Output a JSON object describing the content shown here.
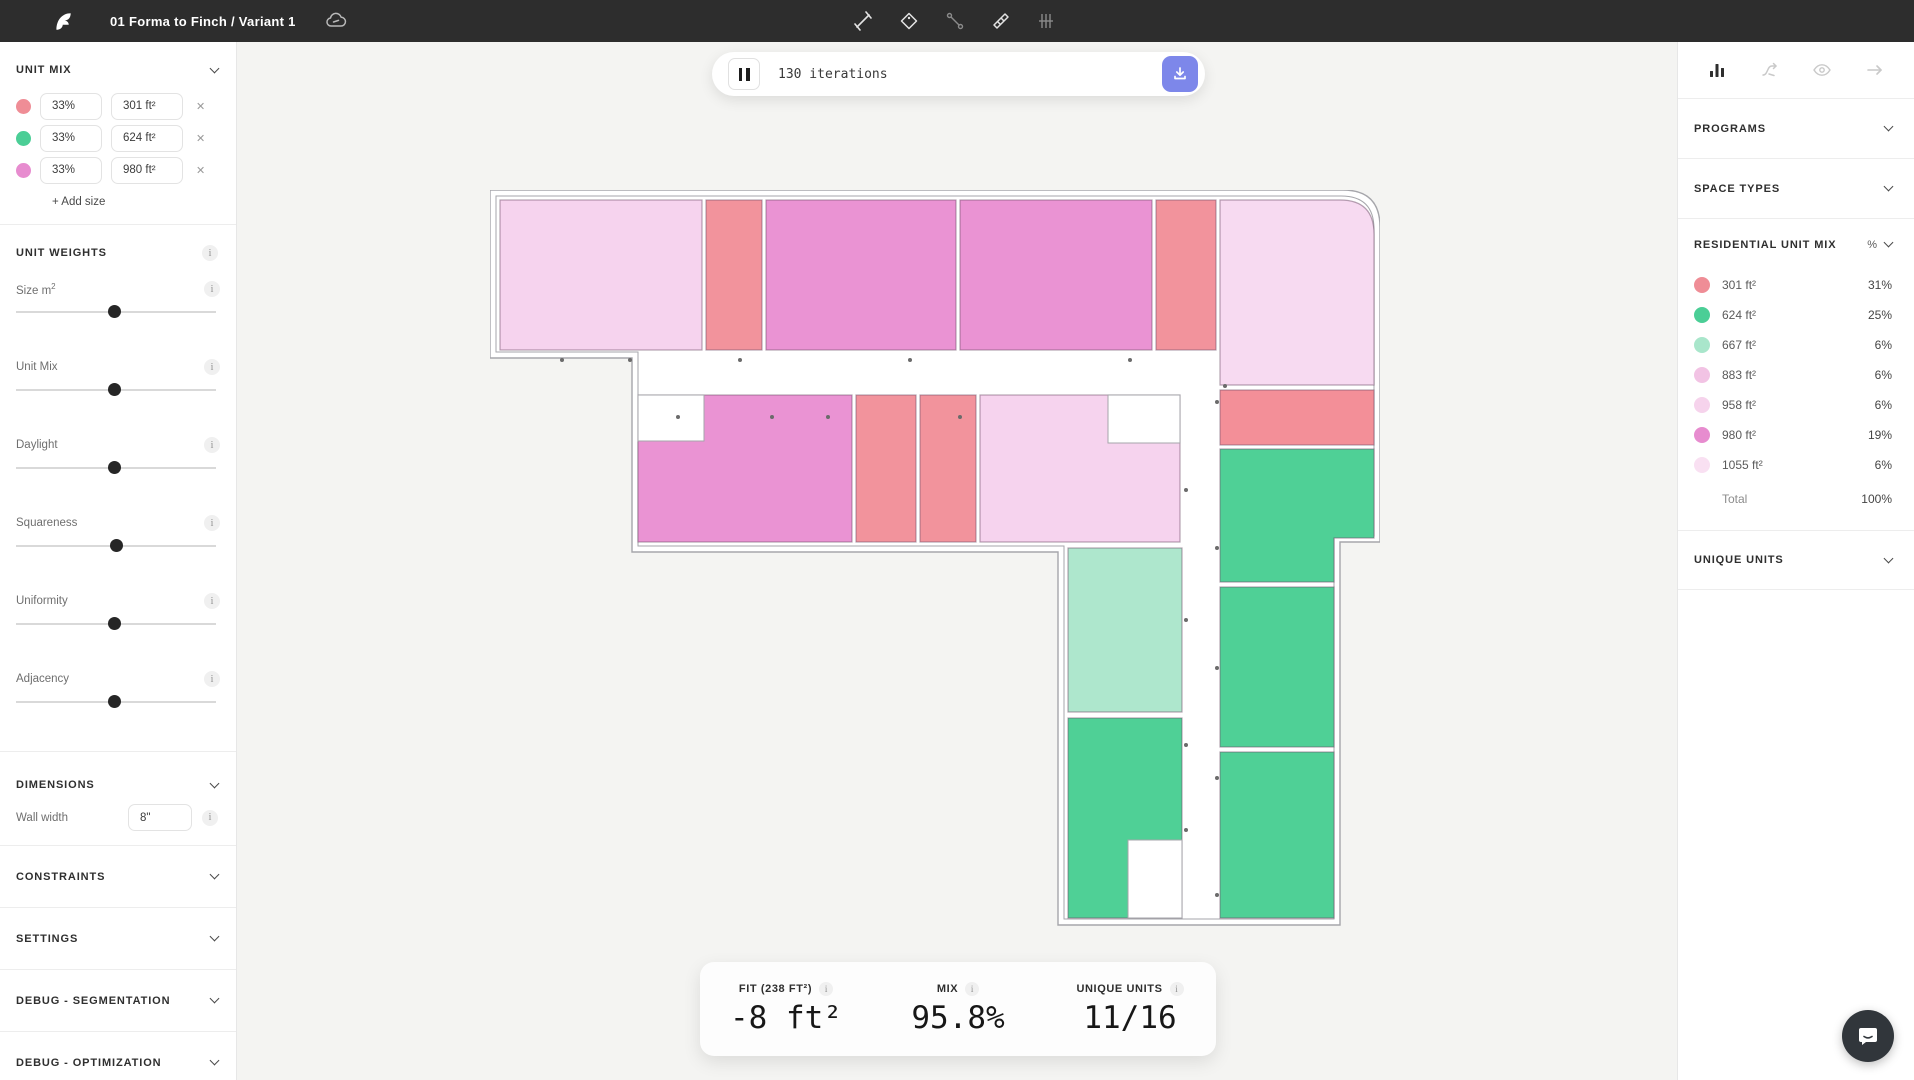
{
  "header": {
    "title": "01 Forma to Finch / Variant 1"
  },
  "iterations": {
    "label": "130 iterations"
  },
  "left_panel": {
    "unit_mix": {
      "title": "UNIT MIX",
      "rows": [
        {
          "pct": "33%",
          "size": "301 ft²",
          "color": "#ef8d96"
        },
        {
          "pct": "33%",
          "size": "624 ft²",
          "color": "#4bce96"
        },
        {
          "pct": "33%",
          "size": "980 ft²",
          "color": "#e78ccf"
        }
      ],
      "add_label": "+ Add size"
    },
    "unit_weights": {
      "title": "UNIT WEIGHTS",
      "sliders": [
        {
          "label": "Size m²",
          "value": 49
        },
        {
          "label": "Unit Mix",
          "value": 49
        },
        {
          "label": "Daylight",
          "value": 49
        },
        {
          "label": "Squareness",
          "value": 50
        },
        {
          "label": "Uniformity",
          "value": 49
        },
        {
          "label": "Adjacency",
          "value": 49
        }
      ]
    },
    "dimensions": {
      "title": "DIMENSIONS",
      "wall_width_label": "Wall width",
      "wall_width_value": "8\""
    },
    "sections": [
      "CONSTRAINTS",
      "SETTINGS",
      "DEBUG - SEGMENTATION",
      "DEBUG - OPTIMIZATION"
    ]
  },
  "right_panel": {
    "programs_title": "PROGRAMS",
    "space_types_title": "SPACE TYPES",
    "residential_unit_mix": {
      "title": "RESIDENTIAL UNIT MIX",
      "unit_header": "%",
      "rows": [
        {
          "size": "301 ft²",
          "pct": "31%",
          "color": "#ef8d96"
        },
        {
          "size": "624 ft²",
          "pct": "25%",
          "color": "#4bce96"
        },
        {
          "size": "667 ft²",
          "pct": "6%",
          "color": "#a9e6cb"
        },
        {
          "size": "883 ft²",
          "pct": "6%",
          "color": "#f2c3e4"
        },
        {
          "size": "958 ft²",
          "pct": "6%",
          "color": "#f6d3ec"
        },
        {
          "size": "980 ft²",
          "pct": "19%",
          "color": "#e78ccf"
        },
        {
          "size": "1055 ft²",
          "pct": "6%",
          "color": "#f9e0f2"
        }
      ],
      "total_label": "Total",
      "total_value": "100%"
    },
    "unique_units_title": "UNIQUE UNITS"
  },
  "stats": {
    "fit_label": "FIT (238 FT²)",
    "fit_value": "-8 ft²",
    "mix_label": "MIX",
    "mix_value": "95.8%",
    "unique_label": "UNIQUE UNITS",
    "unique_value": "11/16"
  },
  "floorplan": {
    "wall_color": "#a6a6ab",
    "unit_stroke": "rgba(110,78,104,0.5)",
    "outer": "M0,0 L853,0 Q890,0 890,37 L890,352 L850,352 L850,735 L568,735 L568,362 L142,362 L142,168 L0,168 Z",
    "inner": "M6,6 L851,6 Q884,6 884,39 L884,346 L844,346 L844,729 L574,729 L574,356 L148,356 L148,162 L6,162 Z",
    "units": [
      {
        "type": "lightpink",
        "color": "#f6d3ee",
        "x": 10,
        "y": 10,
        "w": 202,
        "h": 150
      },
      {
        "type": "salmon",
        "color": "#f2939c",
        "x": 216,
        "y": 10,
        "w": 56,
        "h": 150
      },
      {
        "type": "orchid",
        "color": "#ea93d3",
        "x": 276,
        "y": 10,
        "w": 190,
        "h": 150
      },
      {
        "type": "orchid",
        "color": "#ea93d3",
        "x": 470,
        "y": 10,
        "w": 192,
        "h": 150
      },
      {
        "type": "salmon",
        "color": "#f2939c",
        "x": 666,
        "y": 10,
        "w": 60,
        "h": 150
      },
      {
        "type": "lightpink",
        "color": "#f7daf1",
        "d": "M730,10 L850,10 Q884,10 884,44 L884,195 L730,195 Z"
      },
      {
        "type": "orchid",
        "color": "#ea93d3",
        "x": 148,
        "y": 205,
        "w": 214,
        "h": 147
      },
      {
        "type": "salmon",
        "color": "#f2939c",
        "x": 366,
        "y": 205,
        "w": 60,
        "h": 147
      },
      {
        "type": "salmon",
        "color": "#f2939c",
        "x": 430,
        "y": 205,
        "w": 56,
        "h": 147
      },
      {
        "type": "lightpink",
        "color": "#f6d3ee",
        "x": 490,
        "y": 205,
        "w": 200,
        "h": 147
      },
      {
        "type": "salmon",
        "color": "#f38f98",
        "x": 730,
        "y": 200,
        "w": 154,
        "h": 55
      },
      {
        "type": "green",
        "color": "#4fd096",
        "d": "M730,259 L884,259 L884,348 L844,348 L844,392 L730,392 Z"
      },
      {
        "type": "green",
        "color": "#4fd096",
        "x": 730,
        "y": 397,
        "w": 114,
        "h": 160
      },
      {
        "type": "green",
        "color": "#4fd096",
        "x": 730,
        "y": 562,
        "w": 114,
        "h": 166
      },
      {
        "type": "mint",
        "color": "#aee7cd",
        "x": 578,
        "y": 358,
        "w": 114,
        "h": 164
      },
      {
        "type": "green",
        "color": "#4fd096",
        "x": 578,
        "y": 528,
        "w": 114,
        "h": 200
      }
    ],
    "holes": [
      {
        "x": 148,
        "y": 205,
        "w": 66,
        "h": 46
      },
      {
        "x": 618,
        "y": 205,
        "w": 72,
        "h": 48
      },
      {
        "x": 638,
        "y": 650,
        "w": 54,
        "h": 78
      }
    ],
    "dots": [
      [
        72,
        170
      ],
      [
        140,
        170
      ],
      [
        250,
        170
      ],
      [
        420,
        170
      ],
      [
        640,
        170
      ],
      [
        735,
        196
      ],
      [
        188,
        227
      ],
      [
        282,
        227
      ],
      [
        338,
        227
      ],
      [
        470,
        227
      ],
      [
        696,
        300
      ],
      [
        696,
        430
      ],
      [
        696,
        555
      ],
      [
        696,
        640
      ],
      [
        727,
        212
      ],
      [
        727,
        358
      ],
      [
        727,
        478
      ],
      [
        727,
        588
      ],
      [
        727,
        705
      ]
    ]
  }
}
